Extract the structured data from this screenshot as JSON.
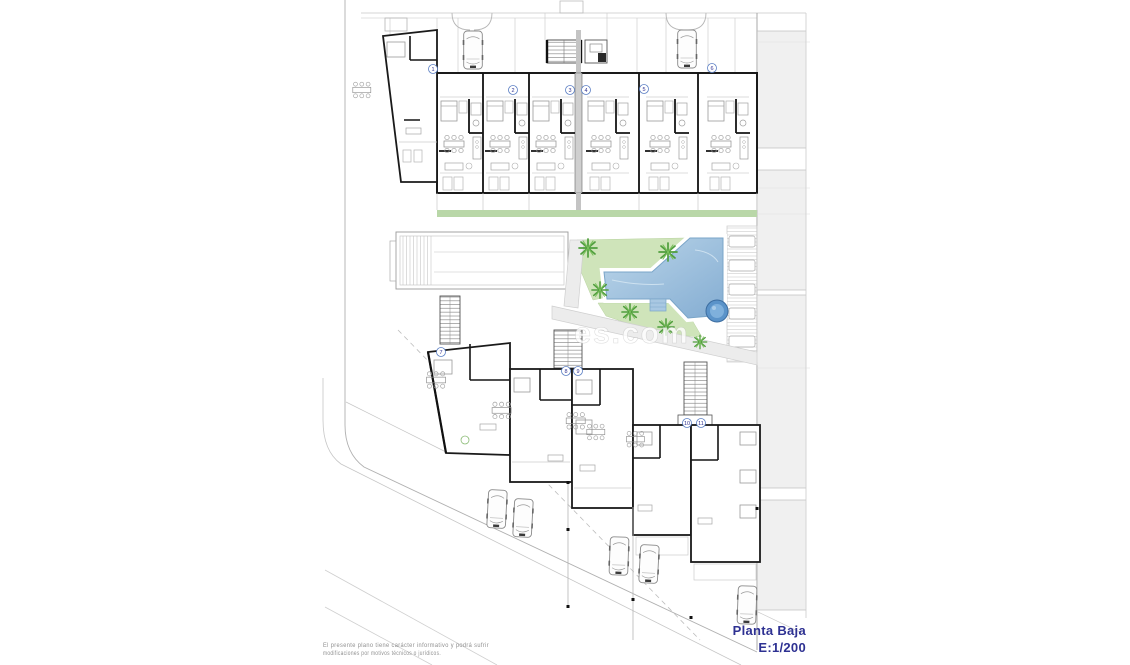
{
  "title_block": {
    "title": "Planta Baja",
    "scale": "E:1/200"
  },
  "disclaimer": {
    "line1": "El presente plano tiene carácter informativo y podrá sufrir",
    "line2": "modificaciones por motivos técnicos o jurídicos."
  },
  "watermark": {
    "visible_text": "es.com"
  },
  "unit_numbers": [
    {
      "number": "1"
    },
    {
      "number": "2"
    },
    {
      "number": "3"
    },
    {
      "number": "4"
    },
    {
      "number": "5"
    },
    {
      "number": "6"
    },
    {
      "number": "7"
    },
    {
      "number": "8"
    },
    {
      "number": "9"
    },
    {
      "number": "10"
    },
    {
      "number": "11"
    }
  ],
  "icons": {
    "car": "car",
    "palm_tree": "palm-tree",
    "staircase": "staircase",
    "pool": "swimming-pool",
    "spa": "circular-spa",
    "hedge": "hedge-strip"
  },
  "colors": {
    "title_text": "#2e3192",
    "walls": "#1a1a1a",
    "thin_lines": "#9a9a9a",
    "pool_fill_light": "#bcd6ea",
    "pool_fill_dark": "#84add2",
    "pool_edge": "#7aa5c8",
    "spa_fill": "#5b93c9",
    "lawn": "#cfe4ba",
    "hedge": "#b9d7a8",
    "palm": "#4f9e3c",
    "paving": "#ececec",
    "neighbor_band": "#f0f0f0",
    "disclaimer_text": "#8f8f8f"
  }
}
